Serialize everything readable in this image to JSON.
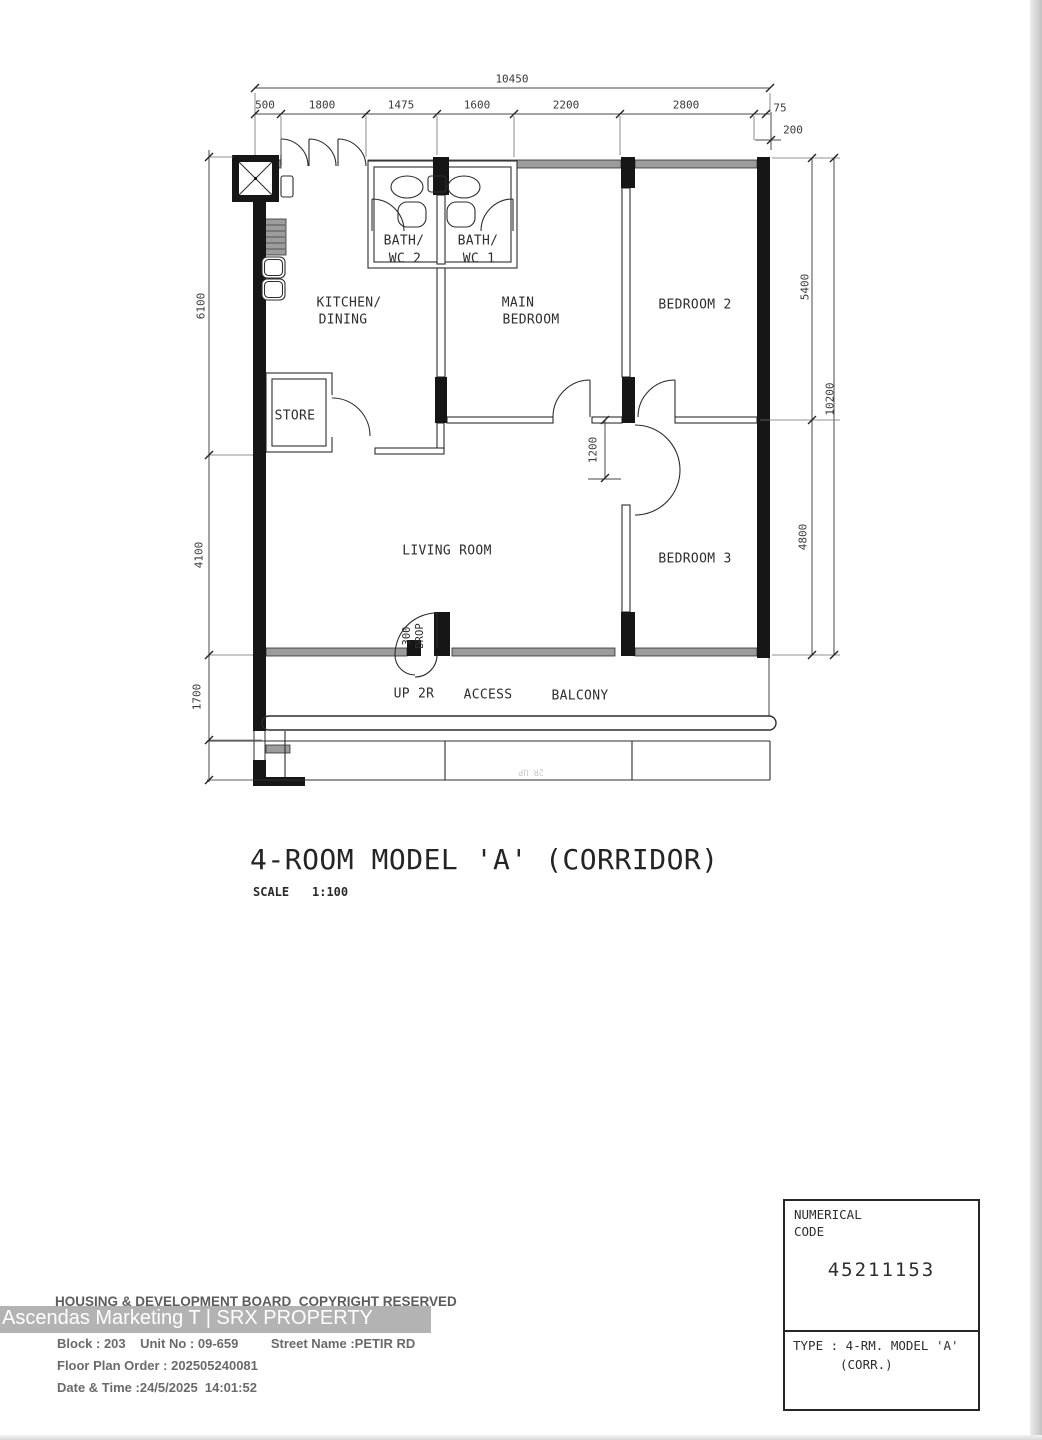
{
  "page": {
    "background": "#ffffff",
    "edge_color": "#c8c8c8"
  },
  "plan": {
    "title": "4-ROOM MODEL 'A' (CORRIDOR)",
    "scale_label": "SCALE",
    "scale_value": "1:100",
    "rooms": {
      "bath2_line1": "BATH/",
      "bath2_line2": "WC 2",
      "bath1_line1": "BATH/",
      "bath1_line2": "WC 1",
      "kitchen_line1": "KITCHEN/",
      "kitchen_line2": "DINING",
      "main_bedroom_line1": "MAIN",
      "main_bedroom_line2": "BEDROOM",
      "bedroom2": "BEDROOM 2",
      "bedroom3": "BEDROOM 3",
      "store": "STORE",
      "living": "LIVING ROOM",
      "up": "UP 2R",
      "access": "ACCESS",
      "balcony": "BALCONY",
      "drop_line1": "300",
      "drop_line2": "DROP",
      "stair_note": "2R UP"
    },
    "dims": {
      "overall_width": "10450",
      "top_segments": [
        "500",
        "1800",
        "1475",
        "1600",
        "2200",
        "2800",
        "75"
      ],
      "wall_offset": "200",
      "left": [
        "6100",
        "4100",
        "1700"
      ],
      "right": [
        "5400",
        "10200",
        "4800"
      ],
      "corridor_width": "1200"
    }
  },
  "footer": {
    "copyright": "HOUSING & DEVELOPMENT BOARD  COPYRIGHT RESERVED",
    "block_line": "Block : 203    Unit No : 09-659         Street Name :PETIR RD",
    "order_line": "Floor Plan Order : 202505240081",
    "datetime_line": "Date & Time :24/5/2025  14:01:52"
  },
  "watermark": {
    "text": "Ascendas Marketing T | SRX PROPERTY"
  },
  "code_box": {
    "label_line1": "NUMERICAL",
    "label_line2": "CODE",
    "value": "45211153",
    "type_line1": "TYPE : 4-RM. MODEL 'A'",
    "type_line2": "(CORR.)"
  }
}
